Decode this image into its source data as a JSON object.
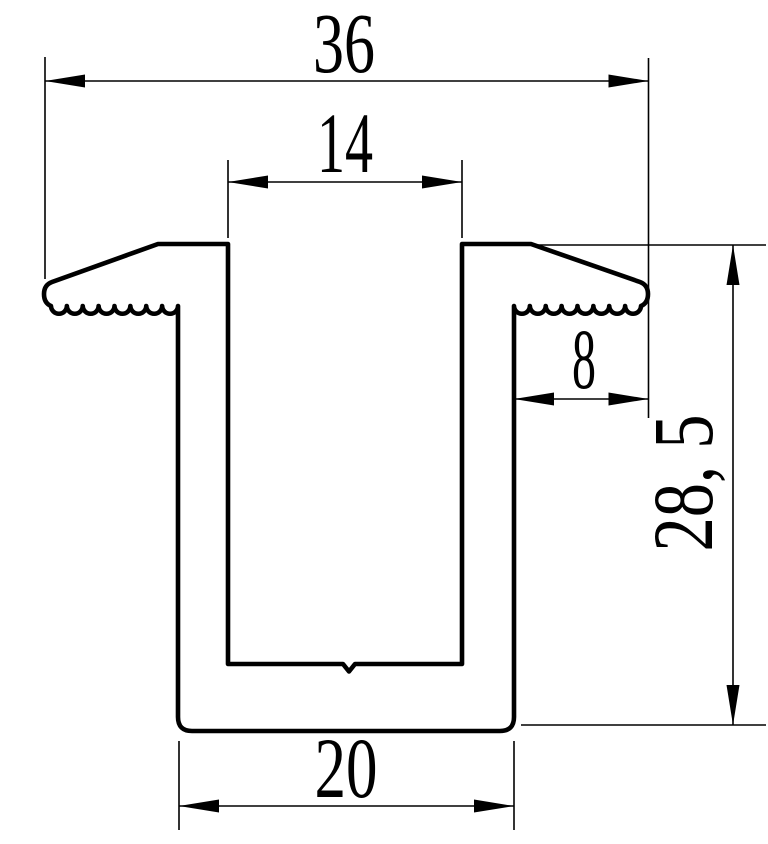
{
  "drawing": {
    "title": "Clamp profile cross-section technical drawing",
    "colors": {
      "background": "#ffffff",
      "line": "#000000"
    },
    "dimensions": {
      "overall_width": "36",
      "slot_width": "14",
      "flange_width": "8",
      "overall_height": "28, 5",
      "base_width": "20"
    }
  }
}
